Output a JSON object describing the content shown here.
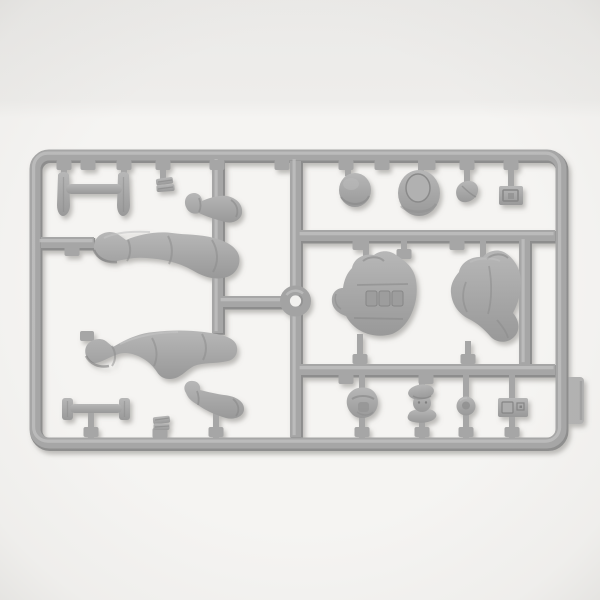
{
  "scene": {
    "type": "product photograph",
    "subject": "Gray injection-molded plastic model-kit sprue (parts tree) with military figure parts on a white backdrop",
    "background_color": "#f5f4f2",
    "backdrop_top_color": "#ebeae8",
    "shadow_color": "#82807c"
  },
  "sprue": {
    "plastic_color": "#a6a6a6",
    "plastic_highlight": "#c1c1c1",
    "plastic_shadow": "#8d8d8d",
    "part_fill_top": "#b7b7b7",
    "part_fill_bottom": "#999999",
    "tab_color": "#b2b2b2",
    "ring_hole_color": "#f2f1ef"
  },
  "parts": [
    {
      "id": "paired-handles",
      "label": "Pair of tool handles with cross bar",
      "location": "top left"
    },
    {
      "id": "folded-part",
      "label": "Small folded equipment part",
      "location": "top left"
    },
    {
      "id": "upper-arm",
      "label": "Bent arm",
      "location": "upper left"
    },
    {
      "id": "straight-legs",
      "label": "Extended legs with boot",
      "location": "middle left"
    },
    {
      "id": "bent-legs",
      "label": "Bent legs with boot",
      "location": "lower left"
    },
    {
      "id": "t-bar-tool",
      "label": "T-shaped tool with end caps",
      "location": "bottom left"
    },
    {
      "id": "stacked-part",
      "label": "Small stacked part",
      "location": "bottom left"
    },
    {
      "id": "lower-arm",
      "label": "Bent arm with hand",
      "location": "bottom left"
    },
    {
      "id": "locator-ring",
      "label": "Round locator ring on runner cross",
      "location": "center"
    },
    {
      "id": "helmet",
      "label": "Dome helmet",
      "location": "top right row"
    },
    {
      "id": "brimmed-hat",
      "label": "Round brimmed hat with crown",
      "location": "top right row"
    },
    {
      "id": "side-cap",
      "label": "Side cap",
      "location": "top right row"
    },
    {
      "id": "belt-pouch",
      "label": "Rectangular belt pouch",
      "location": "top right row"
    },
    {
      "id": "vest-torso",
      "label": "Torso with equipment vest pouches",
      "location": "center right"
    },
    {
      "id": "jacket-torso",
      "label": "Torso with jacket and sleeve",
      "location": "center right"
    },
    {
      "id": "helmeted-head",
      "label": "Helmeted head",
      "location": "bottom right row"
    },
    {
      "id": "capped-head",
      "label": "Head with beret and collar",
      "location": "bottom right row"
    },
    {
      "id": "round-part",
      "label": "Small round part",
      "location": "bottom right row"
    },
    {
      "id": "rect-case",
      "label": "Rectangular case",
      "location": "bottom right row"
    },
    {
      "id": "gate-tab",
      "label": "Sprue gate tab",
      "location": "right edge"
    }
  ]
}
